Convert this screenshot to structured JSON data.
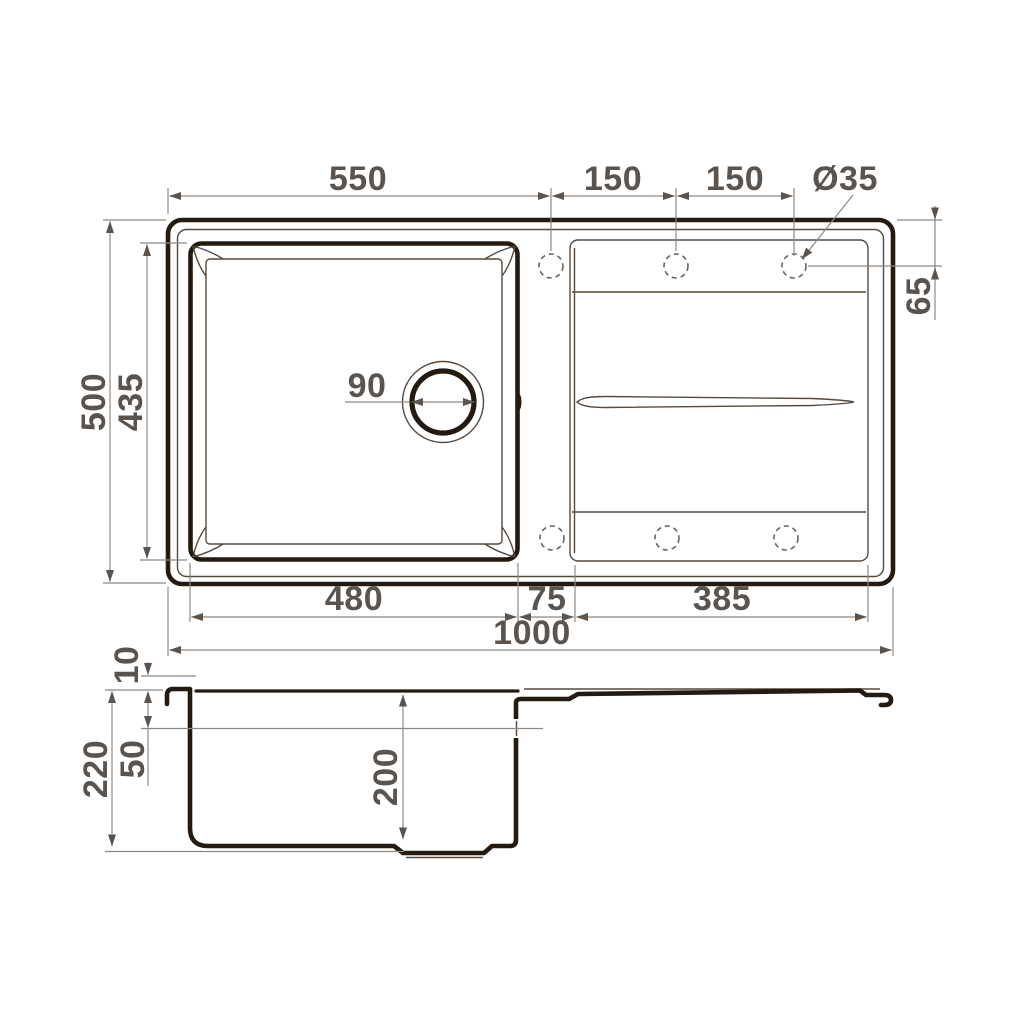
{
  "colors": {
    "object-line": "#241a10",
    "detail-line": "#55493f",
    "dim-line": "#8f8881",
    "dim-text": "#5b534d",
    "background": "#ffffff"
  },
  "top_view": {
    "dim_left_to_first_hole": "550",
    "dim_hole_spacing_1": "150",
    "dim_hole_spacing_2": "150",
    "dim_hole_diameter": "Ø35",
    "dim_overall_depth": "500",
    "dim_bowl_depth": "435",
    "dim_drain_diameter": "90",
    "dim_hole_offset_from_edge": "65",
    "dim_bowl_width": "480",
    "dim_bowl_to_board_gap": "75",
    "dim_board_width": "385",
    "dim_overall_width": "1000"
  },
  "side_view": {
    "dim_rim_height": "10",
    "dim_board_drop": "50",
    "dim_total_height": "220",
    "dim_bowl_inner_depth": "200"
  }
}
